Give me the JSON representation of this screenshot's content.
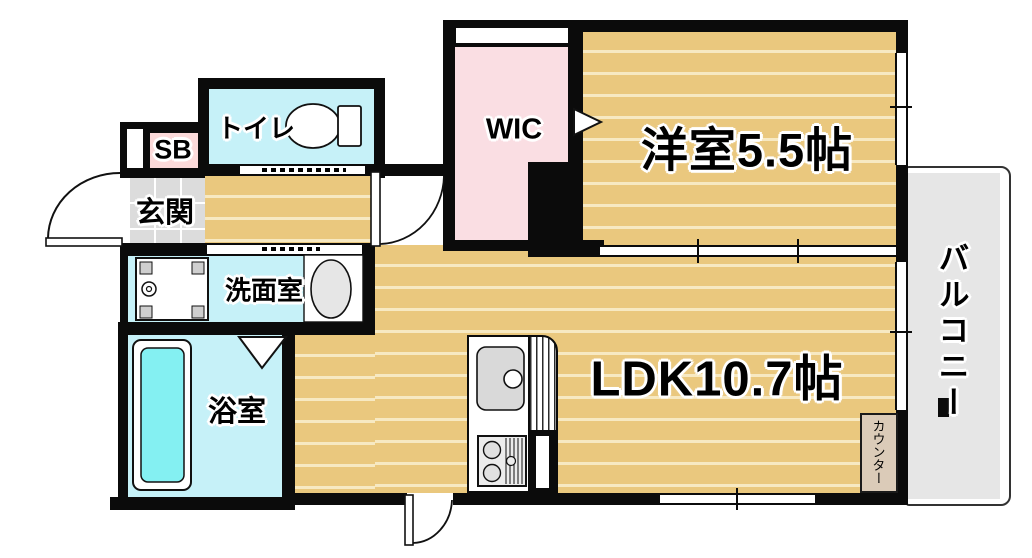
{
  "plan": {
    "type": "apartment-floor-plan",
    "rooms": {
      "toilet": {
        "label": "トイレ"
      },
      "shoe_box": {
        "label": "SB"
      },
      "entrance": {
        "label": "玄関"
      },
      "washroom": {
        "label": "洗面室"
      },
      "bathroom": {
        "label": "浴室"
      },
      "wic": {
        "label": "WIC"
      },
      "western_room": {
        "label": "洋室5.5帖",
        "name": "洋室",
        "size": "5.5帖"
      },
      "ldk": {
        "label": "LDK10.7帖",
        "name": "LDK",
        "size": "10.7帖"
      },
      "balcony": {
        "label": "バルコニー"
      },
      "counter": {
        "label": "カウンター"
      }
    },
    "fixtures": [
      "toilet",
      "washing-machine-pan",
      "washbasin",
      "bathtub",
      "kitchen-sink",
      "gas-stove",
      "entrance-door",
      "hinged-doors",
      "sliding-doors",
      "folding-door-triangles",
      "windows"
    ],
    "colors": {
      "wall": "#0b0b0b",
      "wood_floor": "#eac87e",
      "wood_stripe": "#f7e9c2",
      "wet_room_cyan": "#c6f1f8",
      "tub_water": "#84f0f2",
      "closet_pink": "#fadee3",
      "shoe_box_pink": "#fcdada",
      "entrance_tile": "#dcdcdc",
      "balcony_gray": "#e6e6e6",
      "counter_beige": "#dbcbb8"
    }
  }
}
